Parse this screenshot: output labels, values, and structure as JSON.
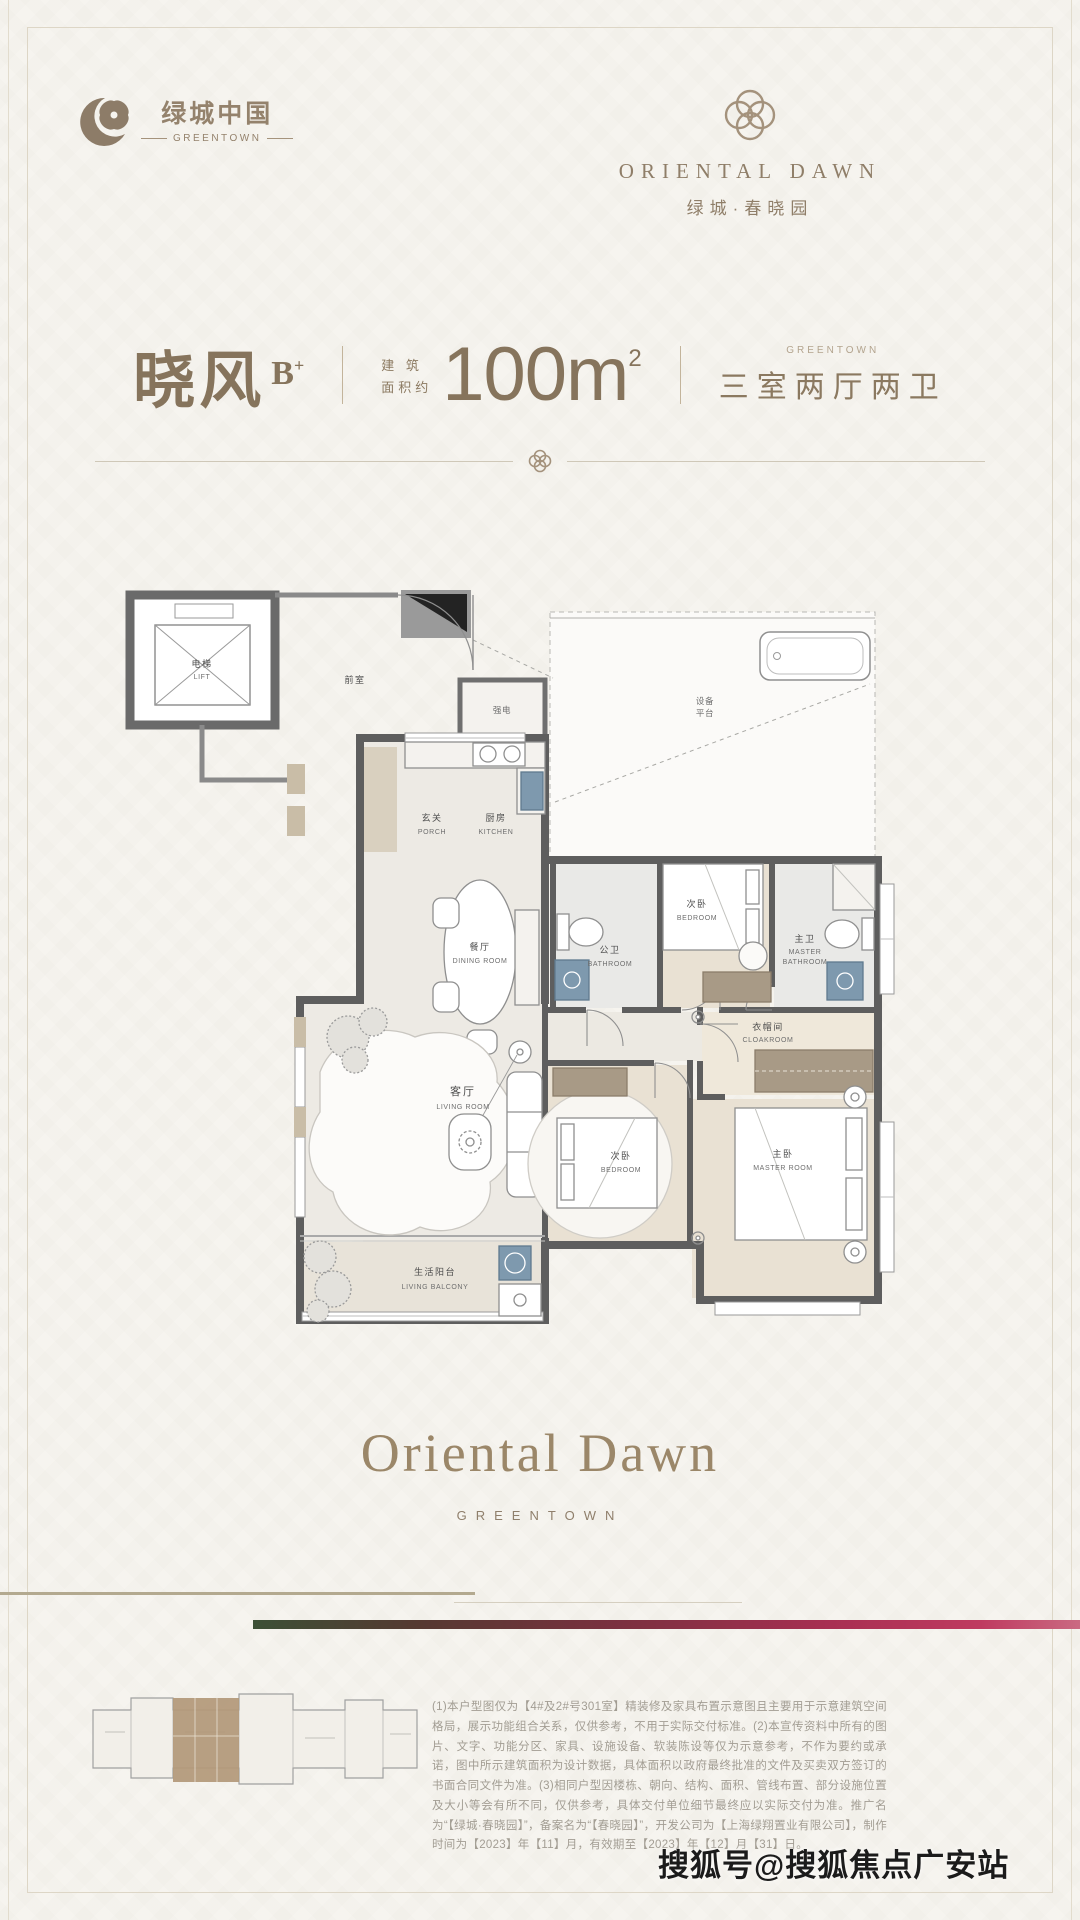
{
  "colors": {
    "background": "#f6f4ef",
    "brand_brown": "#8d7c68",
    "title_brown": "#86745c",
    "wall_gray": "#5e5e5e",
    "fixture_blue": "#7e99ae",
    "tan_rule": "#b3a98f",
    "gradient_bar": [
      "#3c5036",
      "#553931",
      "#7c3040",
      "#a82f52",
      "#bf3a60",
      "#ca6a82"
    ]
  },
  "header": {
    "greentown_logo": {
      "cn": "绿城中国",
      "en": "GREENTOWN"
    },
    "project_logo": {
      "en": "ORIENTAL DAWN",
      "cn": "绿城·春晓园"
    }
  },
  "title": {
    "unit_name": "晓风",
    "unit_grade": "B",
    "unit_grade_sup": "+",
    "area_prefix_line1": "建 筑",
    "area_prefix_line2": "面积约",
    "area_value": "100m",
    "area_sup": "2",
    "overline": "GREENTOWN",
    "layout": "三室两厅两卫"
  },
  "floorplan": {
    "rooms": {
      "lift": {
        "cn": "电梯",
        "en": "LIFT"
      },
      "lobby": {
        "cn": "前室"
      },
      "utility": {
        "cn": "强电"
      },
      "equipment": {
        "line1": "设备",
        "line2": "平台"
      },
      "porch": {
        "cn": "玄关",
        "en": "PORCH"
      },
      "kitchen": {
        "cn": "厨房",
        "en": "KITCHEN"
      },
      "dining": {
        "cn": "餐厅",
        "en": "DINING ROOM"
      },
      "bath": {
        "cn": "公卫",
        "en": "BATHROOM"
      },
      "bedroom2": {
        "cn": "次卧",
        "en": "BEDROOM"
      },
      "master_bath": {
        "cn": "主卫",
        "en1": "MASTER",
        "en2": "BATHROOM"
      },
      "cloakroom": {
        "cn": "衣帽间",
        "en": "CLOAKROOM"
      },
      "living": {
        "cn": "客厅",
        "en": "LIVING ROOM"
      },
      "bedroom3": {
        "cn": "次卧",
        "en": "BEDROOM"
      },
      "master": {
        "cn": "主卧",
        "en": "MASTER ROOM"
      },
      "balcony": {
        "cn": "生活阳台",
        "en": "LIVING BALCONY"
      }
    }
  },
  "footer_logo": {
    "main": "Oriental Dawn",
    "sub": "GREENTOWN"
  },
  "disclaimer": "(1)本户型图仅为【4#及2#号301室】精装修及家具布置示意图且主要用于示意建筑空间格局，展示功能组合关系，仅供参考，不用于实际交付标准。(2)本宣传资料中所有的图片、文字、功能分区、家具、设施设备、软装陈设等仅为示意参考，不作为要约或承诺，图中所示建筑面积为设计数据，具体面积以政府最终批准的文件及买卖双方签订的书面合同文件为准。(3)相同户型因楼栋、朝向、结构、面积、管线布置、部分设施位置及大小等会有所不同，仅供参考，具体交付单位细节最终应以实际交付为准。推广名为“【绿城·春晓园】”，备案名为“【春晓园】”，开发公司为【上海绿翔置业有限公司】，制作时间为【2023】年【11】月，有效期至【2023】年【12】月【31】日。",
  "watermark": "搜狐号@搜狐焦点广安站"
}
